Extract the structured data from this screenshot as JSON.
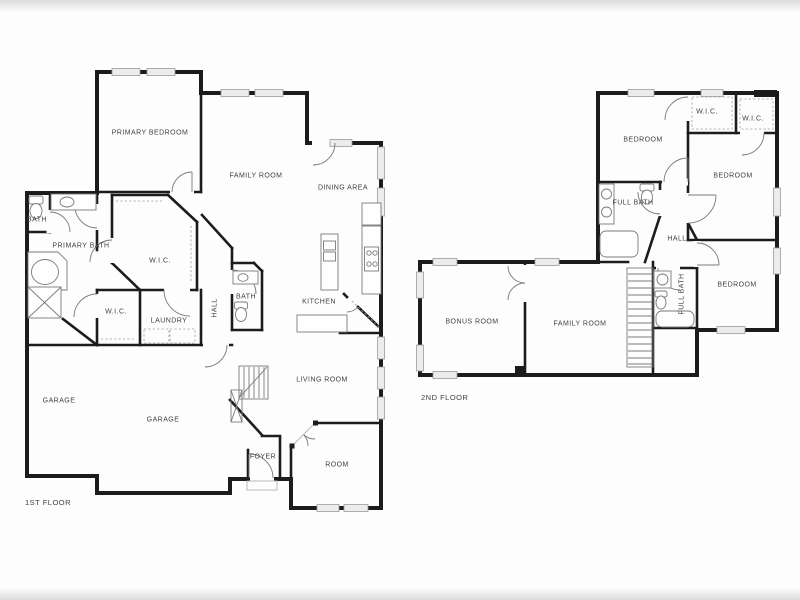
{
  "title": "Two-story house floor plan",
  "colors": {
    "wall": "#1c1c1c",
    "window_fill": "#ececec",
    "window_stroke": "#9b9b9b",
    "fixture": "#7a7a7a",
    "label": "#3f3f3f"
  },
  "floor1": {
    "label": "1ST FLOOR",
    "rooms": [
      {
        "name": "PRIMARY BEDROOM",
        "x": 150,
        "y": 133,
        "vertical": false
      },
      {
        "name": "FAMILY ROOM",
        "x": 256,
        "y": 176,
        "vertical": false
      },
      {
        "name": "DINING AREA",
        "x": 343,
        "y": 188,
        "vertical": false
      },
      {
        "name": "BATH",
        "x": 37,
        "y": 220,
        "vertical": false
      },
      {
        "name": "PRIMARY BATH",
        "x": 81,
        "y": 246,
        "vertical": false
      },
      {
        "name": "W.I.C.",
        "x": 160,
        "y": 261,
        "vertical": false
      },
      {
        "name": "W.I.C.",
        "x": 116,
        "y": 312,
        "vertical": false
      },
      {
        "name": "LAUNDRY",
        "x": 169,
        "y": 321,
        "vertical": false
      },
      {
        "name": "HALL",
        "x": 215,
        "y": 308,
        "vertical": true
      },
      {
        "name": "BATH",
        "x": 246,
        "y": 297,
        "vertical": false
      },
      {
        "name": "KITCHEN",
        "x": 319,
        "y": 302,
        "vertical": false
      },
      {
        "name": "LIVING ROOM",
        "x": 322,
        "y": 380,
        "vertical": false
      },
      {
        "name": "GARAGE",
        "x": 59,
        "y": 401,
        "vertical": false
      },
      {
        "name": "GARAGE",
        "x": 163,
        "y": 420,
        "vertical": false
      },
      {
        "name": "FOYER",
        "x": 263,
        "y": 457,
        "vertical": false
      },
      {
        "name": "ROOM",
        "x": 337,
        "y": 465,
        "vertical": false
      }
    ]
  },
  "floor2": {
    "label": "2ND FLOOR",
    "rooms": [
      {
        "name": "BEDROOM",
        "x": 643,
        "y": 140,
        "vertical": false
      },
      {
        "name": "W.I.C.",
        "x": 707,
        "y": 112,
        "vertical": false
      },
      {
        "name": "W.I.C.",
        "x": 753,
        "y": 119,
        "vertical": false
      },
      {
        "name": "BEDROOM",
        "x": 733,
        "y": 176,
        "vertical": false
      },
      {
        "name": "FULL BATH",
        "x": 633,
        "y": 203,
        "vertical": false
      },
      {
        "name": "HALL",
        "x": 677,
        "y": 239,
        "vertical": false
      },
      {
        "name": "FULL BATH",
        "x": 682,
        "y": 294,
        "vertical": true
      },
      {
        "name": "BEDROOM",
        "x": 737,
        "y": 285,
        "vertical": false
      },
      {
        "name": "BONUS ROOM",
        "x": 472,
        "y": 322,
        "vertical": false
      },
      {
        "name": "FAMILY ROOM",
        "x": 580,
        "y": 324,
        "vertical": false
      }
    ]
  }
}
